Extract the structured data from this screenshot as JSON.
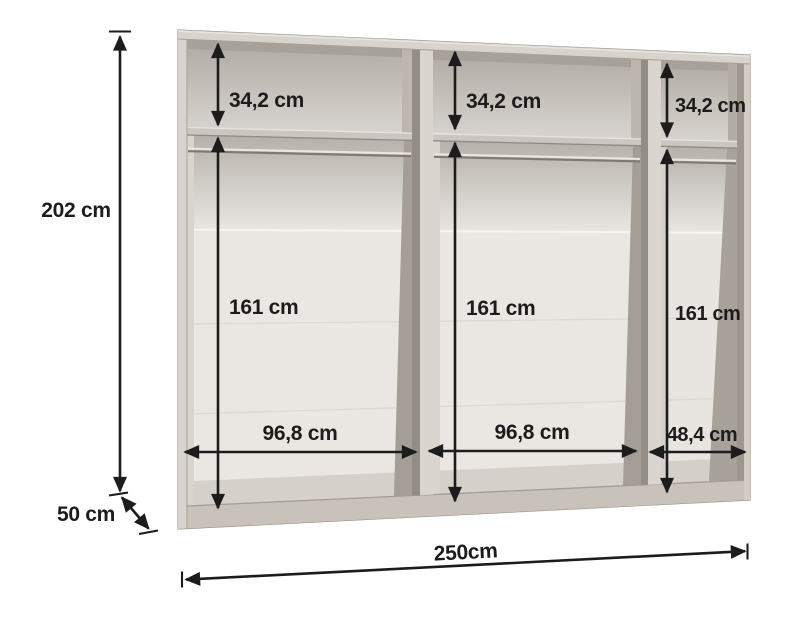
{
  "diagram": {
    "type": "wardrobe-interior-dimension-diagram",
    "dimensions": {
      "height": "202 cm",
      "depth": "50 cm",
      "total_width": "250cm",
      "sections": [
        {
          "position": "left",
          "top_shelf_height": "34,2 cm",
          "hanging_space_height": "161 cm",
          "width": "96,8 cm"
        },
        {
          "position": "middle",
          "top_shelf_height": "34,2 cm",
          "hanging_space_height": "161 cm",
          "width": "96,8 cm"
        },
        {
          "position": "right",
          "top_shelf_height": "34,2 cm",
          "hanging_space_height": "161 cm",
          "width": "48,4 cm"
        }
      ]
    },
    "colors": {
      "background": "#ffffff",
      "dimension_ink": "#1c1c1c",
      "frame_front": "#d8d3cc",
      "frame_side_shadow": "#938d86",
      "interior_back": "#eae7e3",
      "interior_shadow_band": "#b5b0a9",
      "rail_highlight": "#e9e5e0",
      "rail_shadow": "#7f7a74"
    }
  }
}
